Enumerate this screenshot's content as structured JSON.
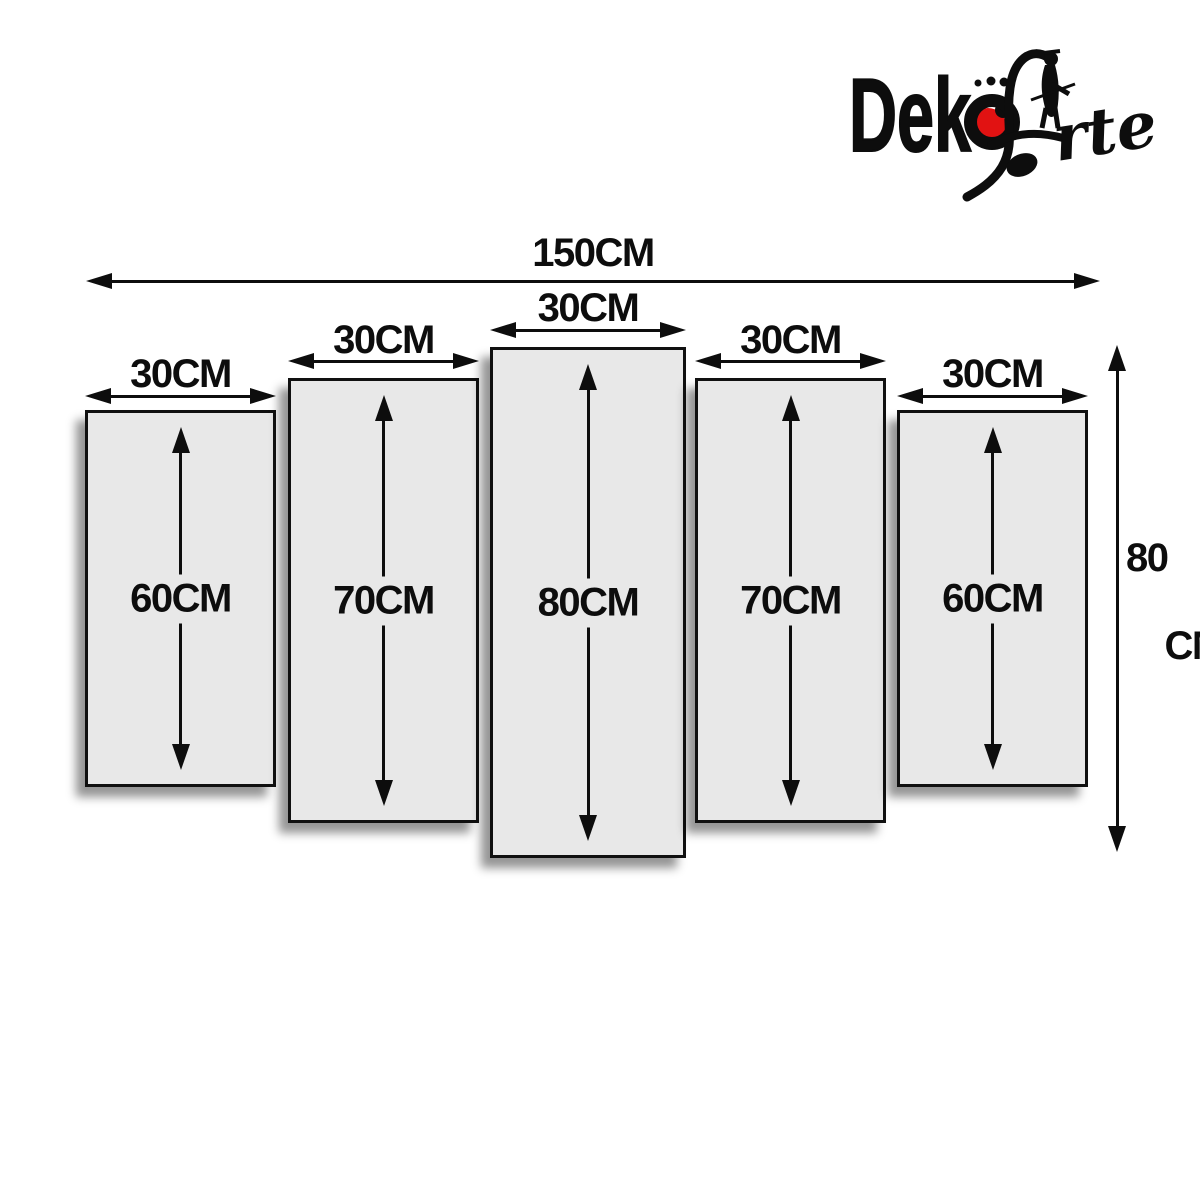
{
  "brand": {
    "name": "DeköArte",
    "wordmark_bold_prefix": "Dek",
    "wordmark_script_word": "Arte",
    "wordmark_script_suffix_visible": "rte",
    "accent_red": "#e11212",
    "ink_black": "#0d0d0d"
  },
  "diagram": {
    "background": "#ffffff",
    "panel_fill": "#e8e8e8",
    "total_width_label": "150CM",
    "total_height_label_line1": "80",
    "total_height_label_line2": "CM",
    "panels": [
      {
        "width_label": "30CM",
        "height_label": "60CM"
      },
      {
        "width_label": "30CM",
        "height_label": "70CM"
      },
      {
        "width_label": "30CM",
        "height_label": "80CM"
      },
      {
        "width_label": "30CM",
        "height_label": "70CM"
      },
      {
        "width_label": "30CM",
        "height_label": "60CM"
      }
    ]
  }
}
